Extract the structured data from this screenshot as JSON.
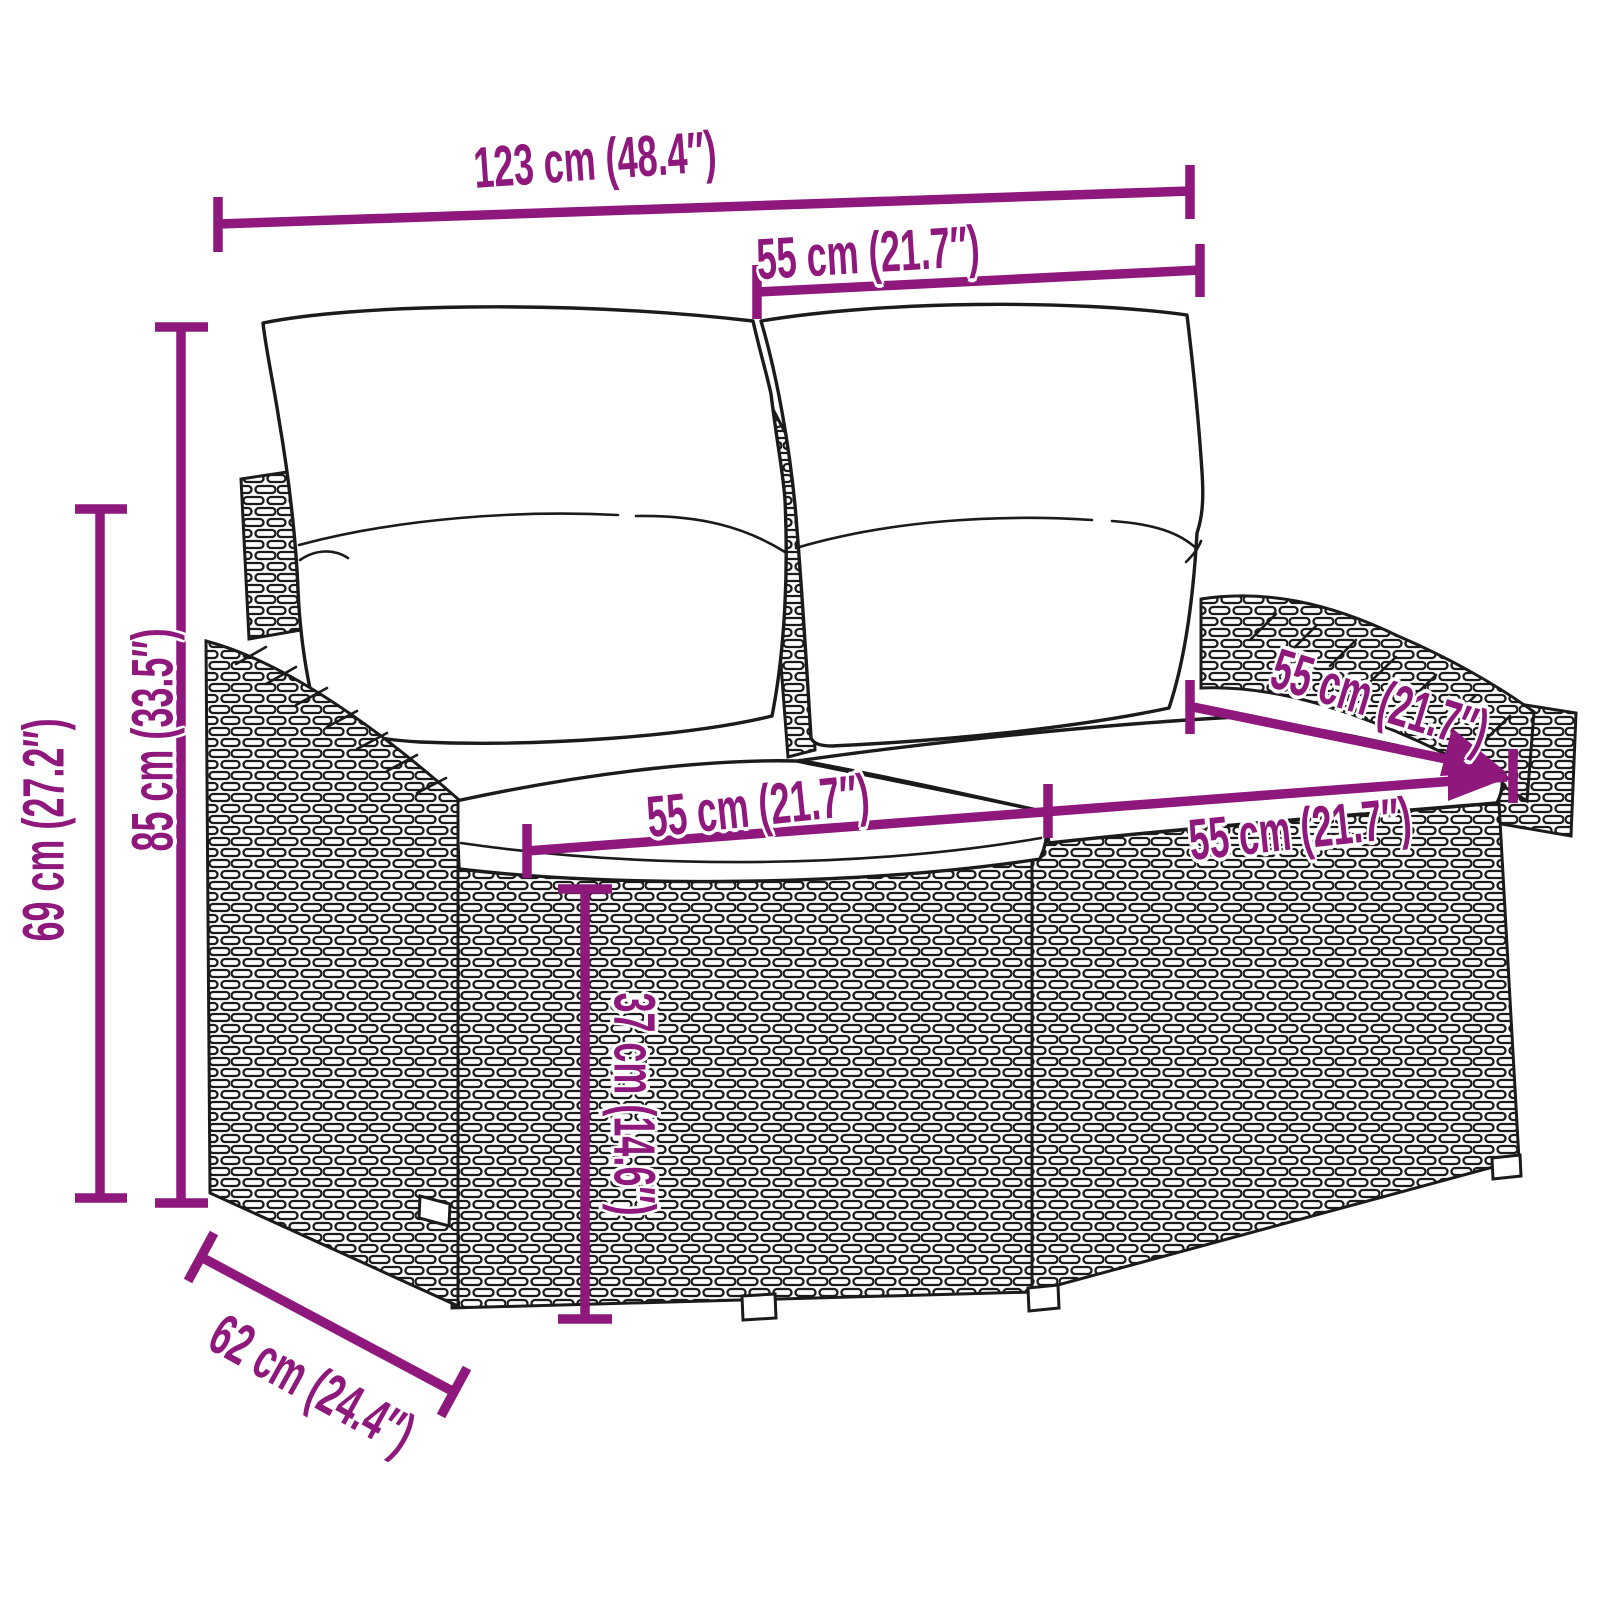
{
  "figure": {
    "type": "product-dimension-diagram",
    "subject": "2-seater poly rattan garden sofa with back and seat cushions"
  },
  "colors": {
    "accent": "#8E187C",
    "ink": "#1b1b1b",
    "background": "#ffffff"
  },
  "dimensions": {
    "overall_width": {
      "label": "123 cm (48.4″)"
    },
    "backrest_cushion_width": {
      "label": "55 cm (21.7″)"
    },
    "total_height": {
      "label": "85 cm (33.5″)"
    },
    "armrest_height": {
      "label": "69 cm (27.2″)"
    },
    "seat_width_left": {
      "label": "55 cm (21.7″)"
    },
    "seat_width_right": {
      "label": "55 cm (21.7″)"
    },
    "seat_depth": {
      "label": "55 cm (21.7″)"
    },
    "seat_height": {
      "label": "37 cm (14.6″)"
    },
    "overall_depth": {
      "label": "62 cm (24.4″)"
    }
  }
}
